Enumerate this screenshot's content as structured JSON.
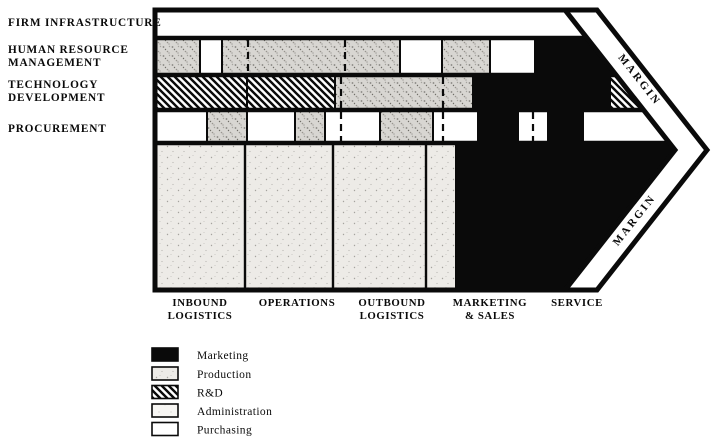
{
  "figure": {
    "type": "value-chain-diagram",
    "support_activities": [
      {
        "lines": [
          "FIRM INFRASTRUCTURE",
          ""
        ]
      },
      {
        "lines": [
          "HUMAN RESOURCE",
          "MANAGEMENT"
        ]
      },
      {
        "lines": [
          "TECHNOLOGY",
          "DEVELOPMENT"
        ]
      },
      {
        "lines": [
          "PROCUREMENT",
          ""
        ]
      }
    ],
    "primary_activities": [
      {
        "lines": [
          "INBOUND",
          "LOGISTICS"
        ]
      },
      {
        "lines": [
          "OPERATIONS",
          ""
        ]
      },
      {
        "lines": [
          "OUTBOUND",
          "LOGISTICS"
        ]
      },
      {
        "lines": [
          "MARKETING",
          "& SALES"
        ]
      },
      {
        "lines": [
          "SERVICE",
          ""
        ]
      }
    ],
    "margin_label_top": "MARGIN",
    "margin_label_bottom": "MARGIN",
    "legend": [
      {
        "label": "Marketing",
        "fill": "solid-black"
      },
      {
        "label": "Production",
        "fill": "light-stipple"
      },
      {
        "label": "R&D",
        "fill": "diagonal-hatch"
      },
      {
        "label": "Administration",
        "fill": "faint-stipple"
      },
      {
        "label": "Purchasing",
        "fill": "white"
      }
    ],
    "colors": {
      "ink": "#0a0a0a",
      "paper": "#ffffff",
      "stipple_dense": "#d8d6d2",
      "stipple_light": "#edebe7"
    }
  }
}
